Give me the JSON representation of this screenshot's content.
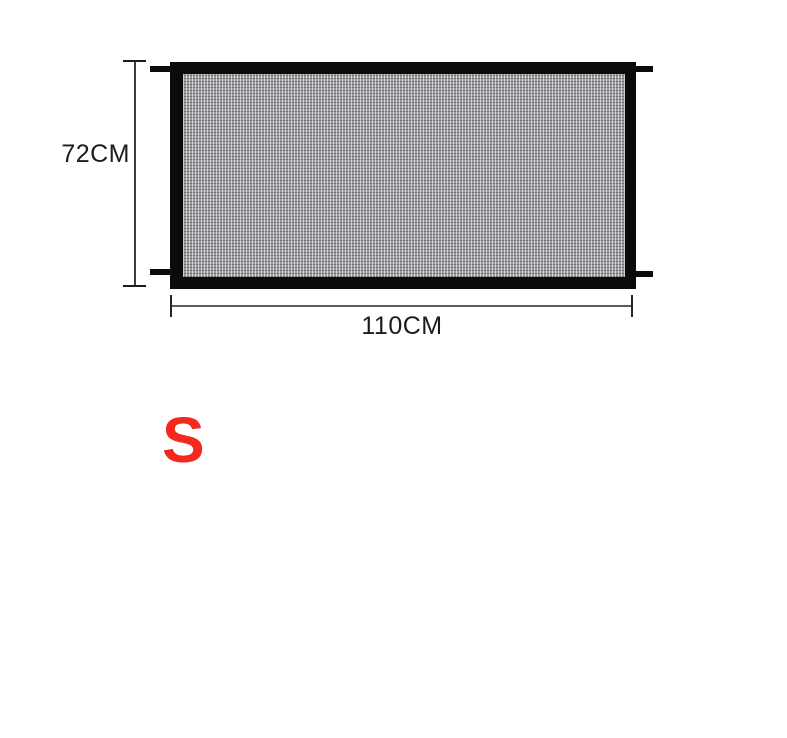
{
  "product_diagram": {
    "type": "mesh-safety-gate-dimension-diagram",
    "height_label": "72CM",
    "width_label": "110CM",
    "size_label": "S",
    "colors": {
      "frame": "#0b0b0b",
      "mesh_base": "#9e9ea2",
      "dimension_line": "#3c3c3c",
      "label_text": "#1c1c1c",
      "size_red": "#f3291d",
      "background": "#ffffff"
    }
  }
}
